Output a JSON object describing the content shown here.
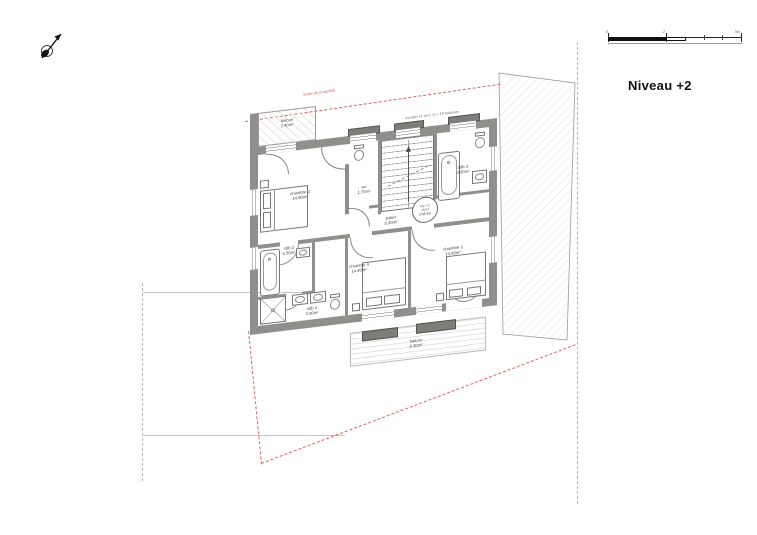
{
  "title": "Niveau +2",
  "annotations": {
    "property_line": "limite de propriété",
    "stair_note": "escalier +1 vers +2 = 14 hauteurs"
  },
  "level_marker": {
    "line1": "niv. +2",
    "line2": "+5.61",
    "line3": "(248.46)"
  },
  "scale_bar": {
    "tick_labels": [
      "0",
      "2",
      "5m"
    ]
  },
  "rooms": {
    "balcon_haut": {
      "name": "balcon",
      "area": "2.40m²"
    },
    "chambre2": {
      "name": "chambre 2",
      "area": "14.90m²"
    },
    "wc": {
      "name": "wc",
      "area": "1.70m²"
    },
    "palier": {
      "name": "palier",
      "area": "8.20m²"
    },
    "sdb3": {
      "name": "sdb 3",
      "area": "4.00m²"
    },
    "sdb2": {
      "name": "sdb 2",
      "area": "5.50m²"
    },
    "sdb4": {
      "name": "sdb 4",
      "area": "3.00m²"
    },
    "chambre4": {
      "name": "chambre 4",
      "area": "14.40m²"
    },
    "chambre3": {
      "name": "chambre 3",
      "area": "14.40m²"
    },
    "balcon_bas": {
      "name": "balcon",
      "area": "6.30m²"
    }
  },
  "colors": {
    "wall": "#8f8f8b",
    "property_red": "#e06060",
    "ink": "#111111"
  }
}
